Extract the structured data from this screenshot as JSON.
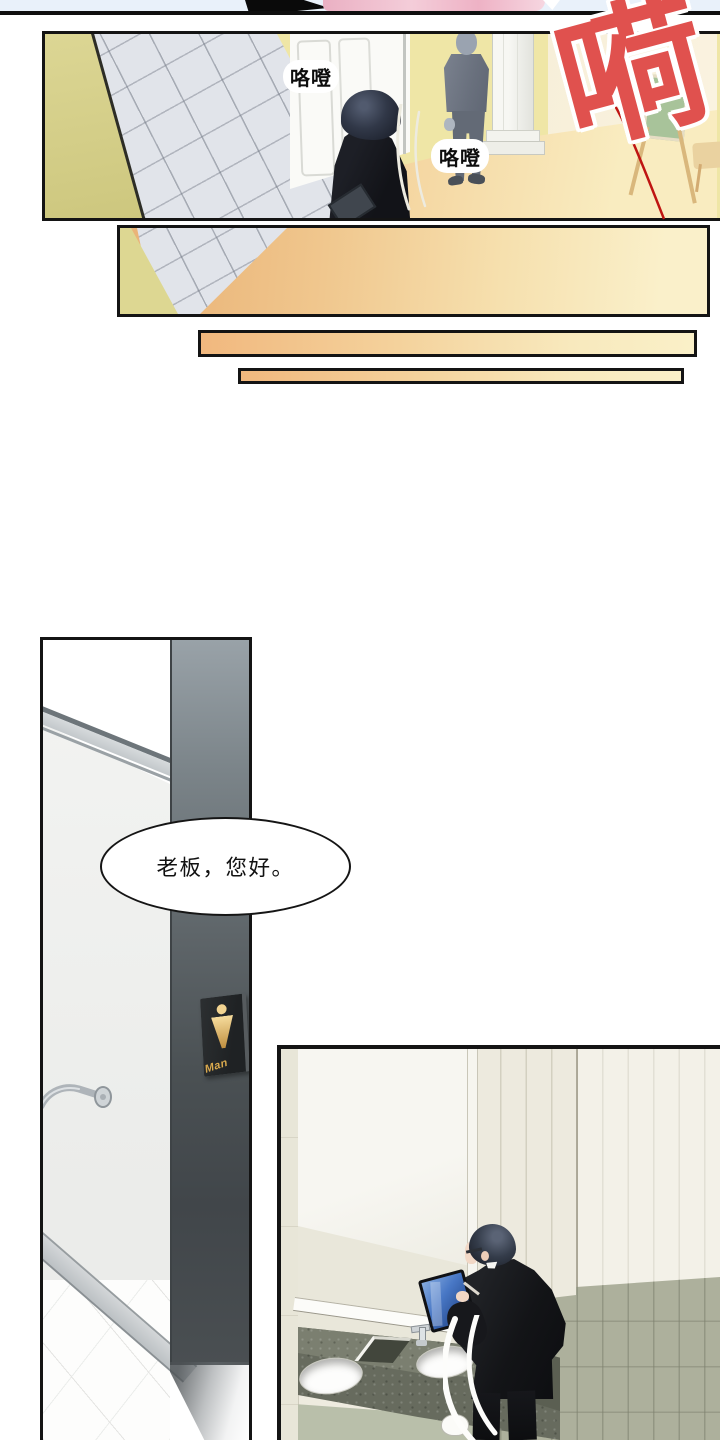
{
  "page": {
    "type": "webtoon-comic-page"
  },
  "panel_hallway": {
    "sfx_footstep_left": "咯噔",
    "sfx_footstep_right": "咯噔",
    "sfx_exclamation": "嗬"
  },
  "panel_door": {
    "sign_label": "Man",
    "dialogue": "老板，您好。"
  },
  "colors": {
    "sfx_red": "#e0514e",
    "string_red": "#bf1512",
    "wall_yellow": "#efe6a6",
    "wall_olive": "#d8d292",
    "floor_orange": "#edb57e",
    "floor_orange_light": "#f9ecc0",
    "tile_gray": "#e1e4ea",
    "door_jamb_gray": "#4d5457",
    "sign_gold": "#d9a94e",
    "counter_gray_green": "#6f7366",
    "wainscot_olive": "#adb09c",
    "suit_black": "#17181b",
    "tablet_blue": "#4877c5",
    "top_strip_blue": "#e9f1fa",
    "pink_shape": "#eeb2c5"
  }
}
